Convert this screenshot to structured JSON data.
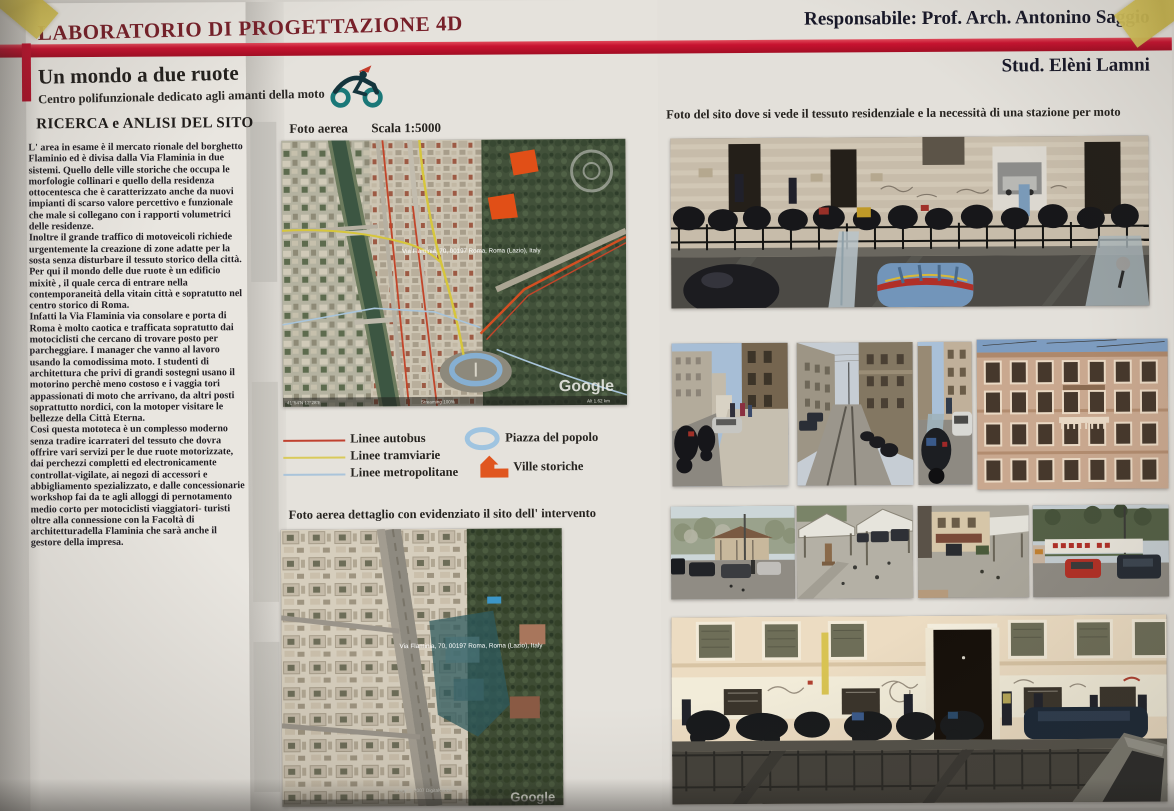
{
  "poster": {
    "lab_title": "LABORATORIO DI PROGETTAZIONE 4D",
    "responsible": "Responsabile: Prof. Arch. Antonino Saggio",
    "student": "Stud. Elèni Lamni",
    "project_title": "Un mondo a due ruote",
    "project_subtitle": "Centro polifunzionale dedicato agli amanti della moto",
    "accent_red": "#c81330",
    "title_color": "#772029"
  },
  "research": {
    "heading": "RICERCA e ANLISI DEL SITO",
    "paragraphs": {
      "0": "L' area in esame è il mercato rionale del borghetto Flaminio ed è divisa dalla Via Flaminia in due sistemi. Quello delle ville storiche che occupa le morfologie collinari e quello della residenza ottocentesca  che è caratterizzato anche da nuovi impianti di scarso valore percettivo e funzionale che male si collegano con i rapporti volumetrici delle residenze.",
      "1": "Inoltre il grande traffico di motoveicoli richiede urgentemente la creazione di zone adatte per la sosta senza disturbare il tessuto storico della città.",
      "2": "Per qui il mondo delle due ruote è un edificio mixitè , il quale cerca di entrare nella contemporaneità della vitain città e sopratutto nel centro storico di Roma.",
      "3": "Infatti la Via Flaminia  via consolare e porta di Roma è molto caotica e trafficata sopratutto dai motociclisti  che cercano di trovare posto per parcheggiare. I manager che vanno al lavoro usando la comodissima moto. I studenti di architettura che privi di grandi sostegni usano il motorino perchè meno costoso e i vaggia tori appassionati di moto che arrivano, da altri posti soprattutto nordici, con la motoper visitare le bellezze della Città Eterna.",
      "4": "Cosi questa mototeca è un complesso moderno senza tradire icarrateri del tessuto che dovra offrire vari servizi per le due ruote motorizzate, dai perchezzi completti ed electronicamente controllat-vigilate, ai negozi di accessori e abbigliamento spezializzato, e dalle concessionarie workshop fai da te agli alloggi di pernotamento medio corto per motociclisti viaggiatori- turisti oltre  alla connessione con la Facoltà di architetturadella Flaminia che sarà anche il gestore della impresa."
    }
  },
  "aerial1": {
    "label": "Foto aerea",
    "scale": "Scala 1:5000",
    "overlay_address": "Via Flaminia, 70, 00197 Roma, Roma (Lazio), Italy",
    "watermark": "Google",
    "status": {
      "left": "41°54'N 12°28'E",
      "mid": "Streaming 100%",
      "right": "Alt 1.62 km"
    }
  },
  "legend": {
    "lines": {
      "0": {
        "label": "Linee autobus",
        "color": "#c0412f"
      },
      "1": {
        "label": "Linee tramviarie",
        "color": "#d9ca5a"
      },
      "2": {
        "label": "Linee metropolitane",
        "color": "#aac4da"
      }
    },
    "areas": {
      "0": {
        "label": "Piazza del popolo",
        "color": "#9fc4e0"
      },
      "1": {
        "label": "Ville storiche",
        "color": "#e0561f"
      }
    }
  },
  "aerial2": {
    "label": "Foto aerea dettaglio con evidenziato il sito dell' intervento",
    "overlay_address": "Via Flaminia, 70, 00197 Roma, Roma (Lazio), Italy",
    "credit": "Image © 2007 DigitalGlobe",
    "watermark": "Google"
  },
  "site_photos": {
    "caption": "Foto del sito dove si vede il tessuto residenziale e la necessità di una stazione per moto",
    "photos": {
      "0": {
        "id": "street-motorcycles-wide"
      },
      "1": {
        "id": "street-sidewalk-bikes"
      },
      "2": {
        "id": "avenue-tram-tracks"
      },
      "3": {
        "id": "street-scooter-narrow"
      },
      "4": {
        "id": "residential-facade"
      },
      "5": {
        "id": "market-street-cars"
      },
      "6": {
        "id": "market-square-fountain"
      },
      "7": {
        "id": "market-square-awnings"
      },
      "8": {
        "id": "market-banner-cars"
      },
      "9": {
        "id": "facade-doorway-scooters"
      }
    }
  },
  "logo": {
    "name": "motorcycle-rider-logo",
    "wheel_color": "#1a7878",
    "flag_color": "#c43b2a"
  }
}
